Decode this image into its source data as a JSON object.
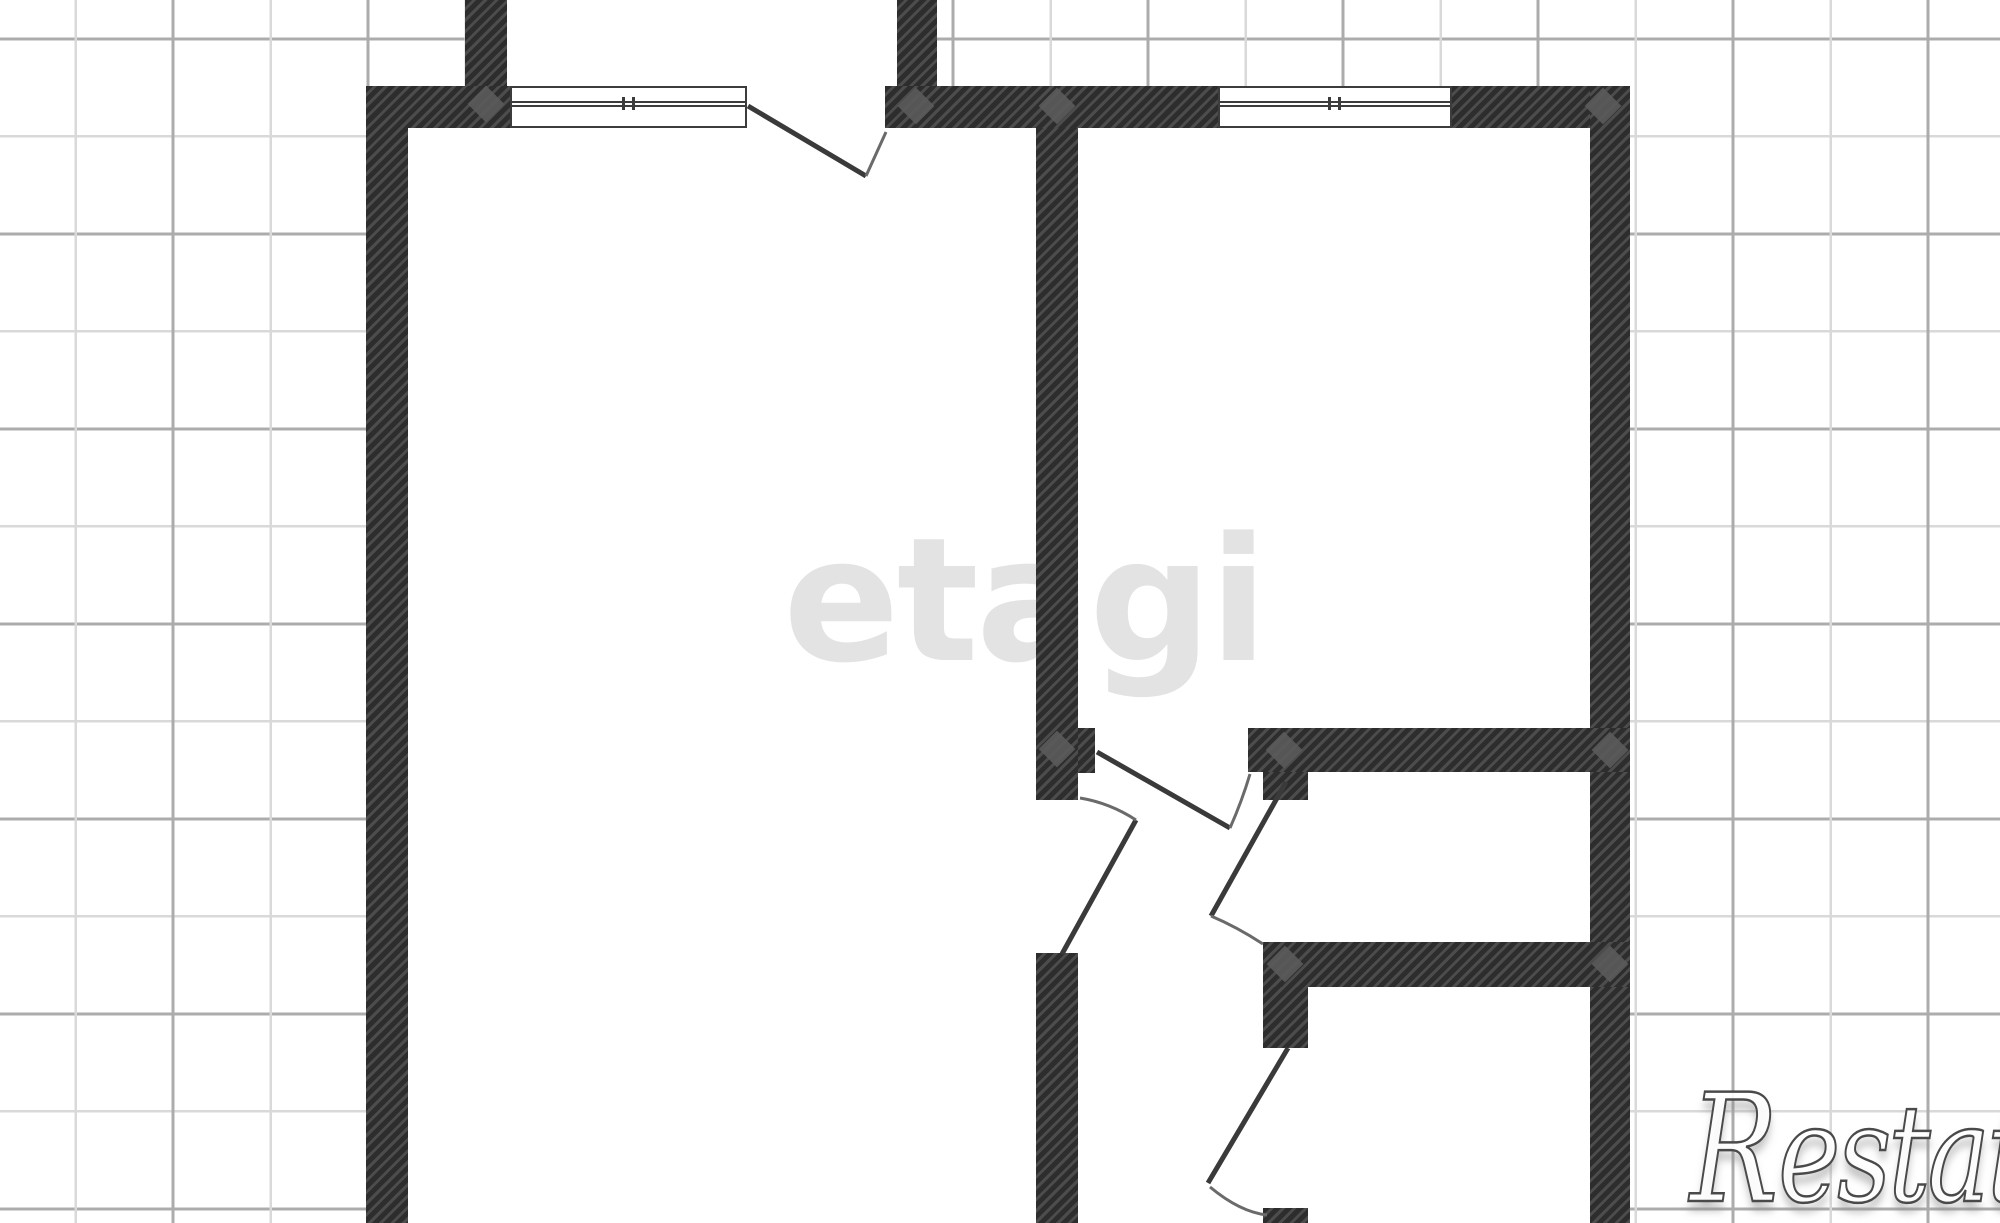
{
  "canvas": {
    "width": 2000,
    "height": 1223,
    "background": "#ffffff"
  },
  "grid": {
    "minor_step": 97.5,
    "major_step": 195,
    "minor_color": "#d9d9d9",
    "major_color": "#acacac"
  },
  "watermarks": {
    "center_logo_text": "etagi",
    "center_logo_color": "#e3e3e3",
    "corner_brand_initial": "R",
    "corner_brand_rest": "estate",
    "corner_outline_color": "#4a4a4a"
  },
  "plan": {
    "wall_dark_color": "#2d2d2d",
    "wall_hatch_color": "#4c4c4c",
    "line_color": "#3a3a3a",
    "swing_arc_color": "#6a6a6a",
    "junction_marker_color": "#5a5a5a",
    "white_regions": [
      {
        "id": "apartment-interior",
        "x": 408,
        "y": 128,
        "w": 1182,
        "h": 1095
      },
      {
        "id": "upper-neighbor-strip",
        "x": 507,
        "y": 0,
        "w": 390,
        "h": 86
      },
      {
        "id": "entrance-opening",
        "x": 747,
        "y": 86,
        "w": 138,
        "h": 42
      }
    ],
    "walls": [
      {
        "id": "top-wall-left",
        "x": 366,
        "y": 86,
        "w": 144,
        "h": 42
      },
      {
        "id": "top-wall-mid",
        "x": 885,
        "y": 86,
        "w": 333,
        "h": 42
      },
      {
        "id": "top-wall-right",
        "x": 1452,
        "y": 86,
        "w": 178,
        "h": 42
      },
      {
        "id": "left-outer-wall",
        "x": 366,
        "y": 86,
        "w": 42,
        "h": 1137
      },
      {
        "id": "right-outer-wall",
        "x": 1590,
        "y": 86,
        "w": 40,
        "h": 1137
      },
      {
        "id": "upper-stub-left",
        "x": 465,
        "y": 0,
        "w": 42,
        "h": 86
      },
      {
        "id": "upper-stub-right",
        "x": 897,
        "y": 0,
        "w": 40,
        "h": 86
      },
      {
        "id": "center-wall-upper",
        "x": 1036,
        "y": 128,
        "w": 42,
        "h": 672
      },
      {
        "id": "center-wall-jamb",
        "x": 1078,
        "y": 728,
        "w": 17,
        "h": 45
      },
      {
        "id": "hall-top-wall",
        "x": 1248,
        "y": 728,
        "w": 382,
        "h": 44
      },
      {
        "id": "hall-top-stub",
        "x": 1263,
        "y": 772,
        "w": 45,
        "h": 28
      },
      {
        "id": "wc-bottom-wall",
        "x": 1263,
        "y": 942,
        "w": 367,
        "h": 45
      },
      {
        "id": "bath-left-stub",
        "x": 1263,
        "y": 987,
        "w": 45,
        "h": 61
      },
      {
        "id": "center-wall-lower",
        "x": 1036,
        "y": 953,
        "w": 42,
        "h": 270
      },
      {
        "id": "bath-left-wall-bottom",
        "x": 1263,
        "y": 1208,
        "w": 45,
        "h": 15
      }
    ],
    "windows": [
      {
        "id": "window-left",
        "x": 510,
        "y": 86,
        "w": 237,
        "h": 42
      },
      {
        "id": "window-right",
        "x": 1218,
        "y": 86,
        "w": 234,
        "h": 42
      }
    ],
    "junction_markers": [
      [
        486,
        104
      ],
      [
        916,
        106
      ],
      [
        1057,
        106
      ],
      [
        1603,
        106
      ],
      [
        1057,
        749
      ],
      [
        1284,
        750
      ],
      [
        1610,
        750
      ],
      [
        1285,
        964
      ],
      [
        1610,
        964
      ]
    ],
    "doors": [
      {
        "id": "entrance-door",
        "leaf": "M748,106 L866,176",
        "arc": "M866,176 Q876,154 886,132"
      },
      {
        "id": "room2-door",
        "leaf": "M1097,752 L1230,828",
        "arc": "M1230,828 Q1242,801 1250,774"
      },
      {
        "id": "wc-door",
        "leaf": "M1286,782 L1211,916",
        "arc": "M1211,916 Q1237,927 1263,944"
      },
      {
        "id": "bath-door",
        "leaf": "M1288,1048 L1208,1183",
        "arc": "M1210,1187 Q1240,1212 1267,1215"
      },
      {
        "id": "room1-door",
        "leaf": "M1062,954 L1136,820",
        "arc": "M1136,820 Q1110,803 1080,798"
      }
    ]
  }
}
